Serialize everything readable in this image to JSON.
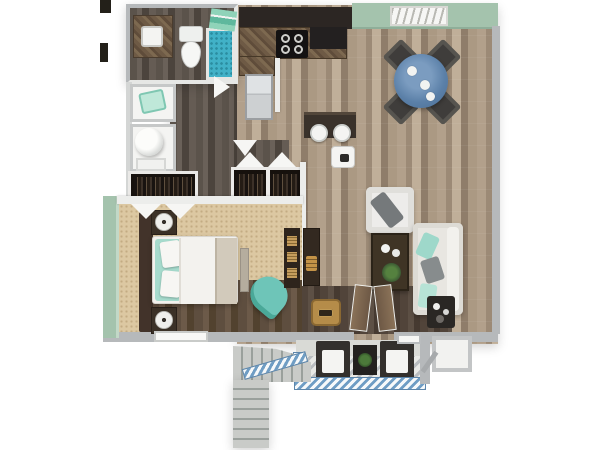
{
  "image": {
    "type": "3d-floor-plan",
    "description": "Top-down 3D floor plan of a one-bedroom, one-bathroom apartment with balcony and exterior staircase",
    "background": "#ffffff"
  },
  "palette": {
    "wall_gray": "#b6b9bb",
    "wall_white": "#ecedeb",
    "wall_green": "#a4c3ad",
    "wood_light": "#a5937f",
    "wood_dark": "#564e46",
    "carpet": "#dcc8a2",
    "counter_dark": "#2c2623",
    "accent_teal": "#6ec5b8",
    "table_blue": "#5b80a8",
    "stairs_gray": "#c9cbc8",
    "railing_blue": "#6f9dc4",
    "water_blue": "#41b1c7"
  },
  "labels": {
    "plan": "One-bedroom apartment 3D floor plan",
    "bathroom": "Bathroom",
    "vanity": "Vanity with sink",
    "toilet": "Toilet",
    "shower": "Walk-in shower",
    "towels": "Towels",
    "laundry": "Utility closet",
    "hamper": "Laundry basket",
    "washer": "Washer / dryer",
    "hallway": "Hallway",
    "coat_closet": "Coat closet",
    "bedroom_closet": "Bedroom closet",
    "kitchen": "Kitchen",
    "cabinets": "Upper cabinets",
    "counter": "Kitchen counter",
    "range": "Range / cooktop",
    "refrigerator": "Refrigerator",
    "island": "Breakfast bar",
    "stool": "Bar stool",
    "pet_bowl": "Floor tray",
    "dining": "Dining area",
    "dining_table": "Round dining table",
    "dining_chair": "Dining chair",
    "window": "Window",
    "living": "Living room",
    "armchair": "Armchair",
    "sofa": "Sofa",
    "coffee_table": "Coffee table with plant",
    "tv_console": "Media console",
    "side_table": "Side table",
    "doormat": "Entry mat",
    "balcony_door": "Balcony french door",
    "bedroom": "Bedroom",
    "bed": "Bed",
    "headboard": "Headboard",
    "nightstand": "Nightstand with lamp",
    "dresser": "Dresser",
    "accent_chair": "Accent chair",
    "bench": "Bench",
    "door_swing": "Door swing",
    "balcony": "Balcony",
    "patio_chair": "Patio chair",
    "patio_table": "Patio table with plant",
    "railing": "Balcony railing",
    "storage": "Outdoor storage closet",
    "entry_door": "Entry door",
    "stairs": "Exterior staircase"
  }
}
